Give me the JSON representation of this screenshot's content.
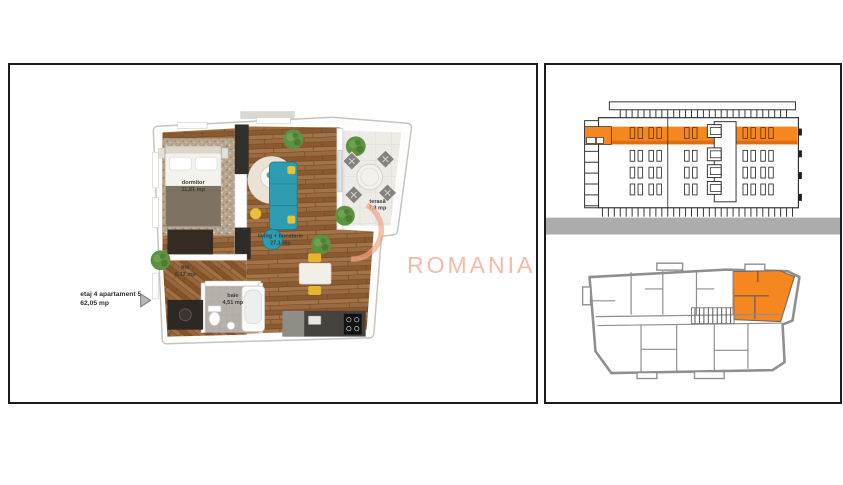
{
  "floor_plan": {
    "unit_label_line1": "etaj 4 apartament 5",
    "unit_label_line2": "62,05 mp",
    "rooms": [
      {
        "name": "dormitor",
        "area": "11,81 mp"
      },
      {
        "name": "living + bucatarie",
        "area": "27,1 mp"
      },
      {
        "name": "terasă",
        "area": "7,3 mp"
      },
      {
        "name": "hol",
        "area": "6,17 mp"
      },
      {
        "name": "baie",
        "area": "4,51 mp"
      }
    ]
  },
  "watermark": {
    "text": "ROMANIA"
  },
  "colors": {
    "highlight": "#F6861F",
    "highlight_dark": "#DE6E12",
    "ground": "#ACACAC",
    "watermark": "#F8B5A0",
    "keyplan_wall": "#8F8F8F"
  }
}
